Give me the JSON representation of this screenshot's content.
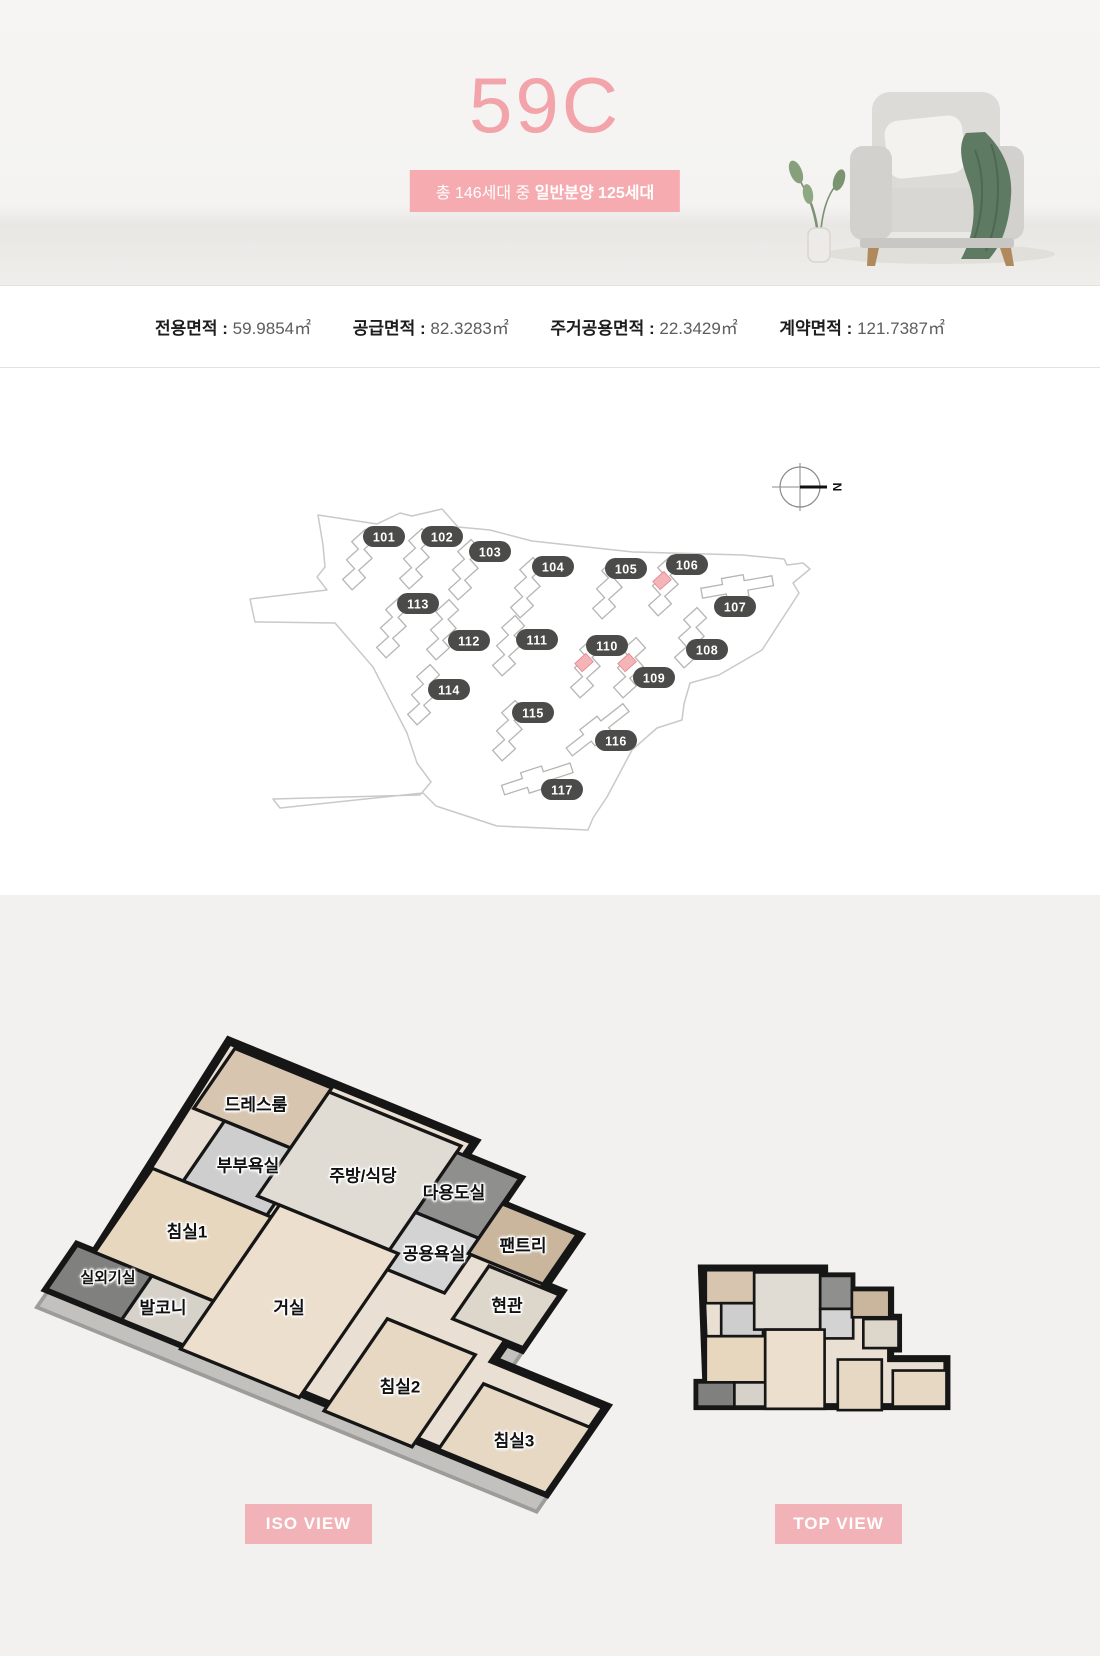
{
  "hero": {
    "unit_name": "59C",
    "badge_prefix": "총 146세대 중 ",
    "badge_bold": "일반분양 125세대"
  },
  "area_info": {
    "separator": " : ",
    "items": [
      {
        "label": "전용면적",
        "value": "59.9854㎡"
      },
      {
        "label": "공급면적",
        "value": "82.3283㎡"
      },
      {
        "label": "주거공용면적",
        "value": "22.3429㎡"
      },
      {
        "label": "계약면적",
        "value": "121.7387㎡"
      }
    ]
  },
  "site_plan": {
    "compass_label": "N",
    "badge_color": "#4b4b49",
    "highlight_color": "#f5b4b8",
    "outline_color": "#c9c9c9",
    "buildings": [
      {
        "no": "101",
        "bx": 384,
        "by": 537,
        "ux": 362,
        "uy": 562,
        "rot": -42,
        "shape": "tower",
        "highlight": false
      },
      {
        "no": "102",
        "bx": 442,
        "by": 537,
        "ux": 419,
        "uy": 561,
        "rot": -42,
        "shape": "tower",
        "highlight": false
      },
      {
        "no": "103",
        "bx": 490,
        "by": 552,
        "ux": 468,
        "uy": 572,
        "rot": -42,
        "shape": "tower",
        "highlight": false
      },
      {
        "no": "104",
        "bx": 553,
        "by": 567,
        "ux": 530,
        "uy": 590,
        "rot": -42,
        "shape": "tower",
        "highlight": false
      },
      {
        "no": "105",
        "bx": 626,
        "by": 569,
        "ux": 612,
        "uy": 591,
        "rot": -42,
        "shape": "tower",
        "highlight": false
      },
      {
        "no": "106",
        "bx": 687,
        "by": 565,
        "ux": 668,
        "uy": 588,
        "rot": -42,
        "shape": "tower",
        "highlight": true
      },
      {
        "no": "107",
        "bx": 735,
        "by": 607,
        "ux": 737,
        "uy": 586,
        "rot": -10,
        "shape": "strip",
        "highlight": false
      },
      {
        "no": "108",
        "bx": 707,
        "by": 650,
        "ux": 694,
        "uy": 640,
        "rot": -42,
        "shape": "tower",
        "highlight": false
      },
      {
        "no": "109",
        "bx": 654,
        "by": 678,
        "ux": 633,
        "uy": 670,
        "rot": -42,
        "shape": "tower",
        "highlight": true
      },
      {
        "no": "110",
        "bx": 607,
        "by": 646,
        "ux": 590,
        "uy": 670,
        "rot": -42,
        "shape": "tower",
        "highlight": true
      },
      {
        "no": "111",
        "bx": 537,
        "by": 640,
        "ux": 512,
        "uy": 648,
        "rot": -42,
        "shape": "tower",
        "highlight": false
      },
      {
        "no": "112",
        "bx": 469,
        "by": 641,
        "ux": 446,
        "uy": 632,
        "rot": -42,
        "shape": "tower",
        "highlight": false
      },
      {
        "no": "113",
        "bx": 418,
        "by": 604,
        "ux": 396,
        "uy": 630,
        "rot": -42,
        "shape": "tower",
        "highlight": false
      },
      {
        "no": "114",
        "bx": 449,
        "by": 690,
        "ux": 427,
        "uy": 697,
        "rot": -42,
        "shape": "tower",
        "highlight": false
      },
      {
        "no": "115",
        "bx": 533,
        "by": 713,
        "ux": 512,
        "uy": 733,
        "rot": -42,
        "shape": "tower",
        "highlight": false
      },
      {
        "no": "116",
        "bx": 616,
        "by": 741,
        "ux": 597,
        "uy": 729,
        "rot": -38,
        "shape": "strip",
        "highlight": false
      },
      {
        "no": "117",
        "bx": 562,
        "by": 790,
        "ux": 537,
        "uy": 778,
        "rot": -18,
        "shape": "strip",
        "highlight": false
      }
    ]
  },
  "floor_plan": {
    "rooms": [
      "드레스룸",
      "부부욕실",
      "주방/식당",
      "다용도실",
      "침실1",
      "공용욕실",
      "팬트리",
      "실외기실",
      "발코니",
      "거실",
      "현관",
      "침실2",
      "침실3"
    ],
    "views": [
      {
        "label": "ISO VIEW"
      },
      {
        "label": "TOP VIEW"
      }
    ]
  }
}
